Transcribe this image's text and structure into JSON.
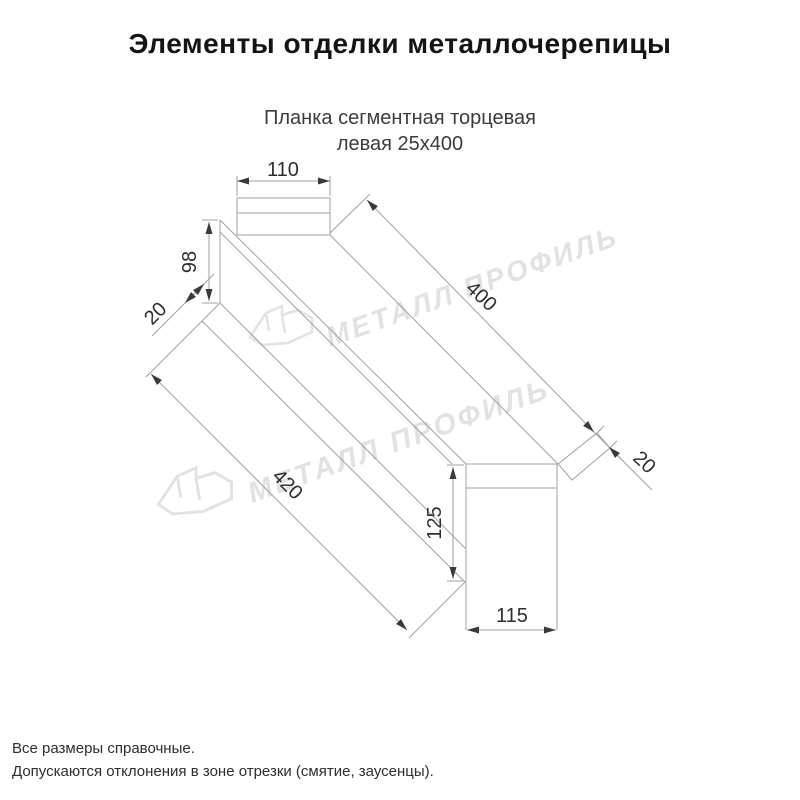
{
  "page": {
    "title": "Элементы отделки металлочерепицы",
    "subtitle_line1": "Планка сегментная торцевая",
    "subtitle_line2": "левая 25х400"
  },
  "drawing": {
    "product": "Планка сегментная торцевая левая 25х400",
    "dimensions": {
      "top_flange_width": "110",
      "left_face_height": "98",
      "left_fold": "20",
      "top_edge_length": "400",
      "right_fold": "20",
      "bottom_edge_length": "420",
      "end_cap_height": "125",
      "end_cap_width": "115"
    },
    "colors": {
      "line": "#a0a0a0",
      "dimension_text": "#2e2e2e",
      "arrow": "#3a3a3a"
    }
  },
  "watermark": {
    "text": "МЕТАЛЛ ПРОФИЛЬ",
    "color": "#e2e2e2"
  },
  "footer": {
    "line1": "Все размеры справочные.",
    "line2": "Допускаются отклонения в зоне отрезки (смятие, заусенцы)."
  }
}
